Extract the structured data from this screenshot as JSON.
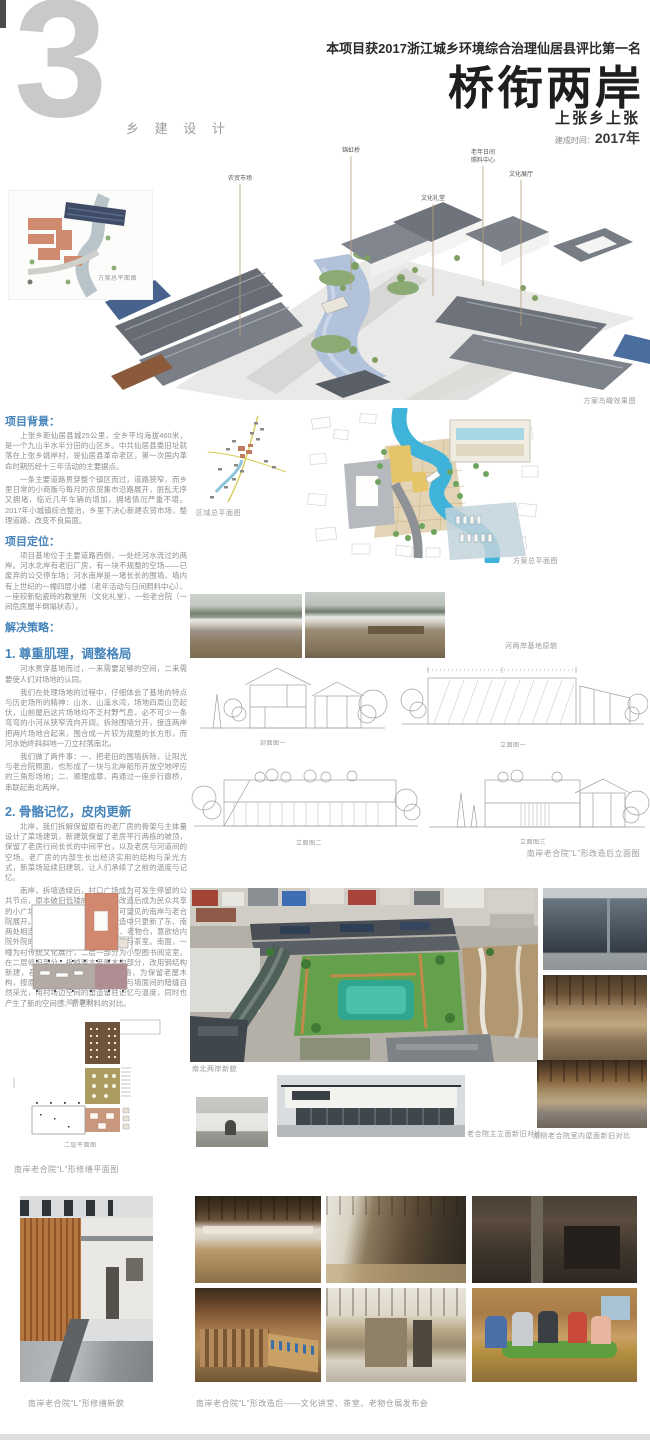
{
  "header": {
    "section_number": "3",
    "section_label": "乡 建 设 计",
    "award": "本项目获2017浙江城乡环境综合治理仙居县评比第一名",
    "title": "桥衔两岸",
    "location": "上张乡上张",
    "completion_label": "建成时间：",
    "completion_year": "2017年"
  },
  "axon": {
    "caption": "方案鸟瞰效果图",
    "label_market": "农贸市场",
    "label_bridge": "锦虹桥",
    "label_hall": "文化礼堂",
    "label_elderly_1": "老年日间",
    "label_elderly_2": "照料中心",
    "label_exhibit": "文化展厅"
  },
  "captions": {
    "site_small": "方案总平面图",
    "regional": "区域总平面图",
    "master": "方案总平面图",
    "before_photos": "河两岸基地原貌",
    "section1": "剖面图一",
    "elevation1": "立面图一",
    "elevation2": "立面图二",
    "elevation3": "立面图三",
    "elevation_note": "南岸老合院“L”形改造后立面图",
    "floor1": "一层平面图",
    "floor2": "二层平面图",
    "floor_note": "南岸老合院“L”形修缮平面图",
    "aerial": "南北两岸新貌",
    "facade_compare": "老合院主立面新旧对比",
    "interior_compare": "南侧老合院室内屋面新旧对比",
    "courtyard_new": "南岸老合院“L”形修缮新貌",
    "program": "南岸老合院“L”形改造后——文化讲堂、茶室、老物仓展发布会"
  },
  "sections": [
    {
      "heading": "项目背景：",
      "paragraphs": [
        "上张乡距仙居县城25公里，全乡平均海拔460米，是一个九山半水半分田的山区乡。中共仙居县委旧址就落在上张乡姚岸村，是仙居县革命老区，第一次国内革命时期历经十三年活动的主要据点。",
        "一条主要道路贯穿整个镇区而过，道路狭窄，而乡里日常的小商贩与每月的农贸集市沿路展开，脏乱无序又拥堵，临近几年车辆的增加，拥堵情况严重不堪。2017年小城镇综合整治，乡里下决心新建农贸市场，整理道路，改变不良局面。"
      ]
    },
    {
      "heading": "项目定位：",
      "paragraphs": [
        "项目基地位于主要道路西侧，一处经河水流过的两岸。河水北岸有老旧厂房，有一块不规整的空场——已废弃的公交停车场；河水南岸是一堵长长的围墙，墙内有上世纪的一幢四层小楼（老年活动与日间照料中心）、一座较新贴瓷砖的教堂所（文化礼堂）、一些老合院（一间危房屋半倒塌状态）。"
      ]
    },
    {
      "heading": "解决策略：",
      "paragraphs": []
    },
    {
      "heading": "1. 尊重肌理，调整格局",
      "paragraphs": [
        "河水贯穿基地而过，一来需要足够的空间，二来需要使人们对场地的认同。",
        "我们在处理场地的过程中，仔细体会了基地的特点与历史场所的精神：山水、山溪水湾，场地四周山峦起伏，山前屋后这片场地均不乏村野气息，必不可少一条弯弯的小河从狭窄流向开阔。拆除围墙分开，接连两岸把两片场地合起来，围合成一片较为规整的长方形，而河水始终斜斜地一刀立村落南北。",
        "我们做了两件事：一、把老旧的围墙拆除，让阳光与老合院照面，也形成了一块与北岸船形开放空地呼应的三角形场地；二、顺理成章，再通过一座步行廊桥，串联起南北两岸。"
      ]
    },
    {
      "heading": "2. 骨骼记忆，皮肉更新",
      "paragraphs": [
        "北岸，我们拆解保留原有的老厂房的骨架与主体量设计了菜场建筑，新建筑保留了老房平行两栋的坡顶，保留了老房行间长长的中间平台，以及老房与河道间的空场。老厂房的内部生长出经济实用的结构与采光方式，新菜场延续旧建筑，让人们承续了之前的温度与记忆。",
        "南岸，拆墙透绿后，村口广场成为可发生停留的公共节点，原本破旧低矮的村居，在改造后成为民众共享的小广场。就此，实现相邻厂房与可望见的南岸与老合院展开。由于经费原因，老合院改造中只更新了东、南两处相连的“L”形房屋。一层设茶室、老物仓，意欲给内院外院的共享大厅；二层设文化讲堂与茶室。南面，一幢为村传统文化展厅，二层一部分为小型图书阅览室。在二层修旧部分，拆掉原本老屋木构部分，改用钢结构新建，石砌墙体保留，老柱立一侧墙，为保留老屋木构，按原样重做屋顶等，增加了屋顶与墙面间的暗缝自然采光，用村场边空间的塑造留驻记忆与温度，同时也产生了新的空间感、新老材料的对比。"
      ]
    }
  ],
  "colors": {
    "accent_blue": "#4584ba",
    "river_blue": "#3fb3da",
    "salmon": "#d0896f",
    "body_gray": "#8f8f8f"
  }
}
